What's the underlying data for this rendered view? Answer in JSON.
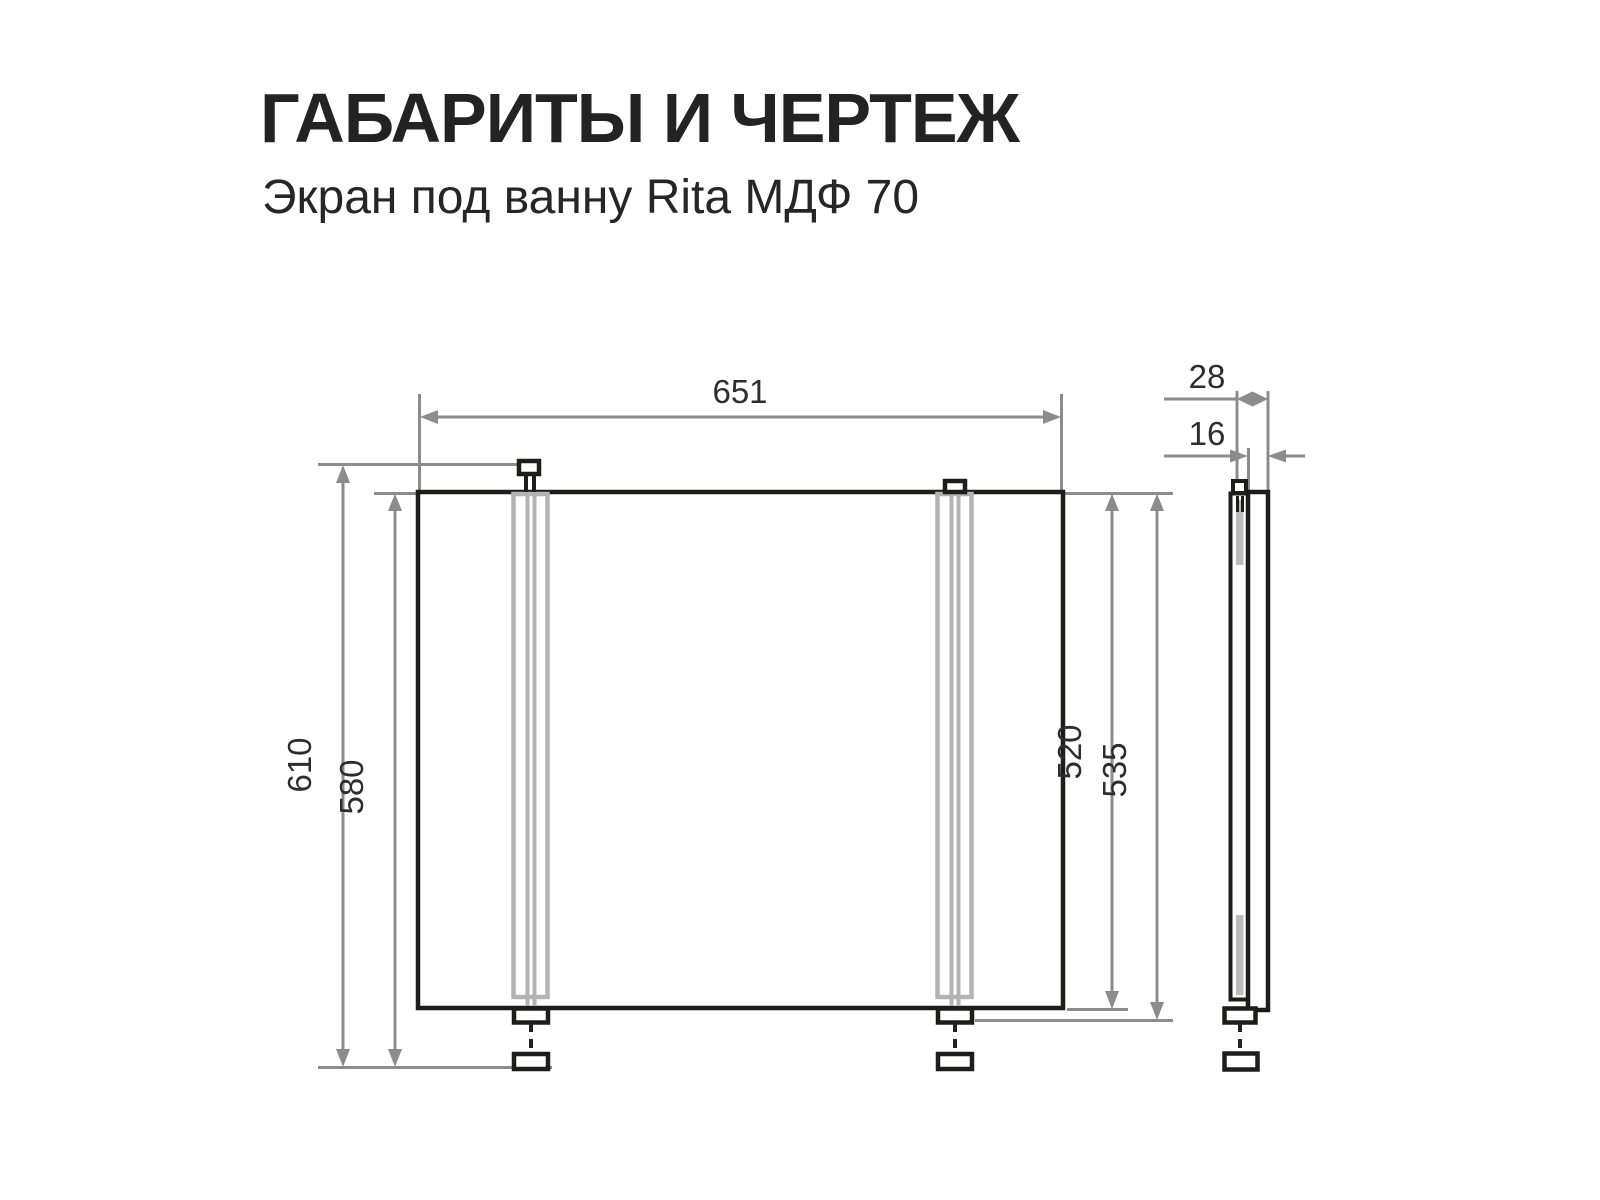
{
  "header": {
    "title": "ГАБАРИТЫ И ЧЕРТЕЖ",
    "subtitle": "Экран под ванну Rita МДФ 70"
  },
  "drawing": {
    "dimensions": {
      "width": "651",
      "overall_height": "610",
      "height_to_foot": "580",
      "panel_height": "520",
      "panel_with_bracket_height": "535",
      "overall_depth": "28",
      "panel_thickness": "16"
    },
    "colors": {
      "part_outline": "#1d1d1b",
      "dimension_line": "#8c8c8c",
      "rail_gray": "#b3b3b3",
      "label_text": "#2d2d2d",
      "background": "#ffffff"
    }
  }
}
